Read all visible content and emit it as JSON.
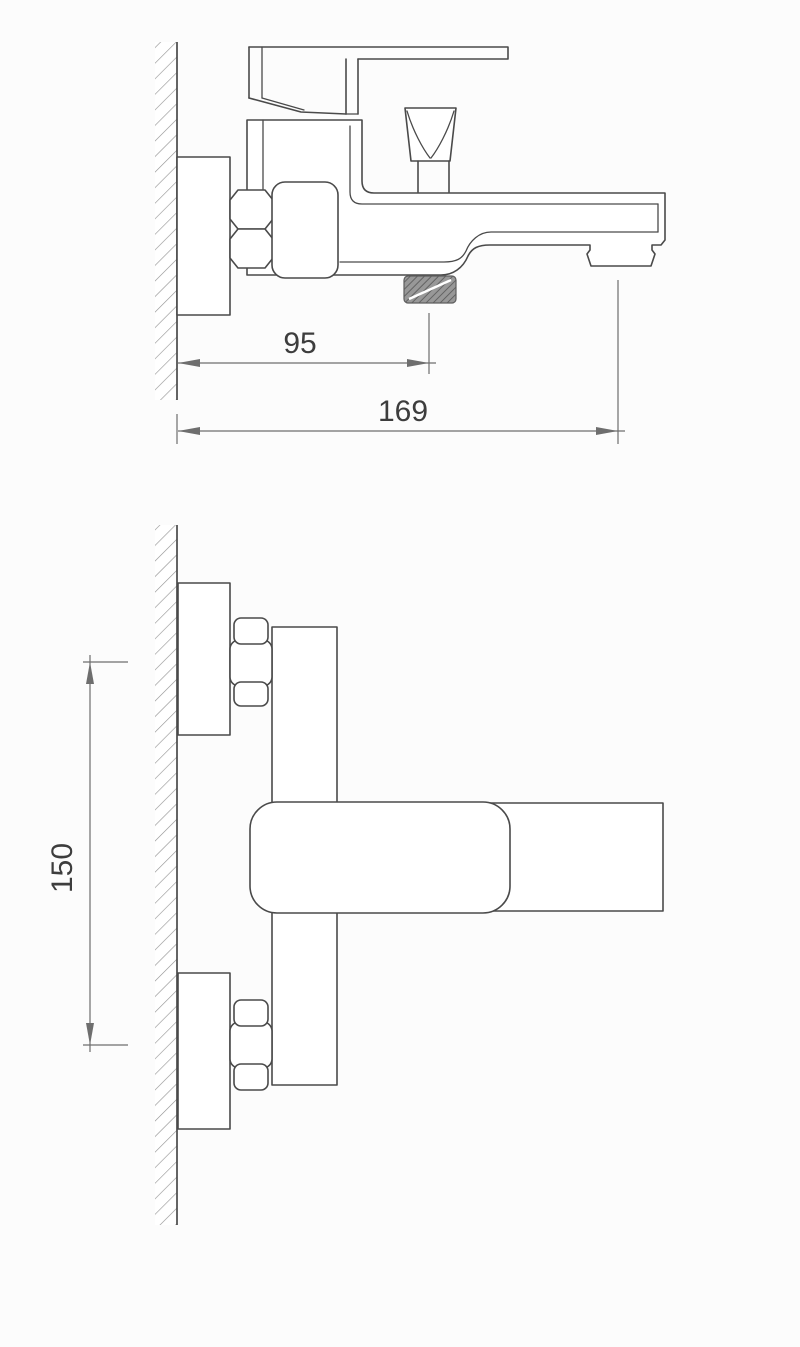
{
  "drawing": {
    "kind": "bath-mixer-faucet-installation-drawing",
    "views": {
      "side_view": {
        "dimensions": {
          "wall_to_shower_outlet_mm": "95",
          "wall_to_spout_outlet_mm": "169"
        }
      },
      "plan_view": {
        "dimensions": {
          "inlet_centers_distance_mm": "150"
        }
      }
    }
  },
  "theme": {
    "background": "#fcfcfc",
    "line_color": "#4a4a4a",
    "dimension_line_color": "#6e6e6e",
    "dimension_text_color": "#3d3d3d",
    "wall_hatch_color": "#909090",
    "thread_fill_color": "#989898",
    "thread_stripe_color": "#565656"
  }
}
